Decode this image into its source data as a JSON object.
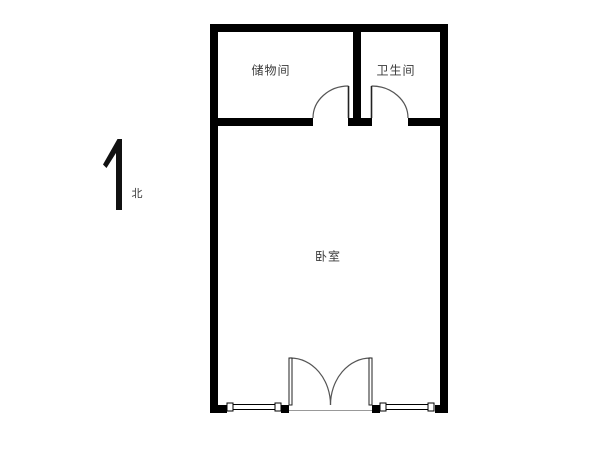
{
  "floorplan": {
    "rooms": [
      {
        "id": "storage",
        "label": "储物间"
      },
      {
        "id": "bathroom",
        "label": "卫生间"
      },
      {
        "id": "bedroom",
        "label": "卧室"
      }
    ],
    "compass": {
      "label": "北",
      "icon": "north-arrow-icon"
    },
    "colors": {
      "wall": "#000000",
      "door_line": "#555555",
      "thin_line": "#222222",
      "text": "#3a3a3a",
      "background": "#ffffff"
    }
  }
}
